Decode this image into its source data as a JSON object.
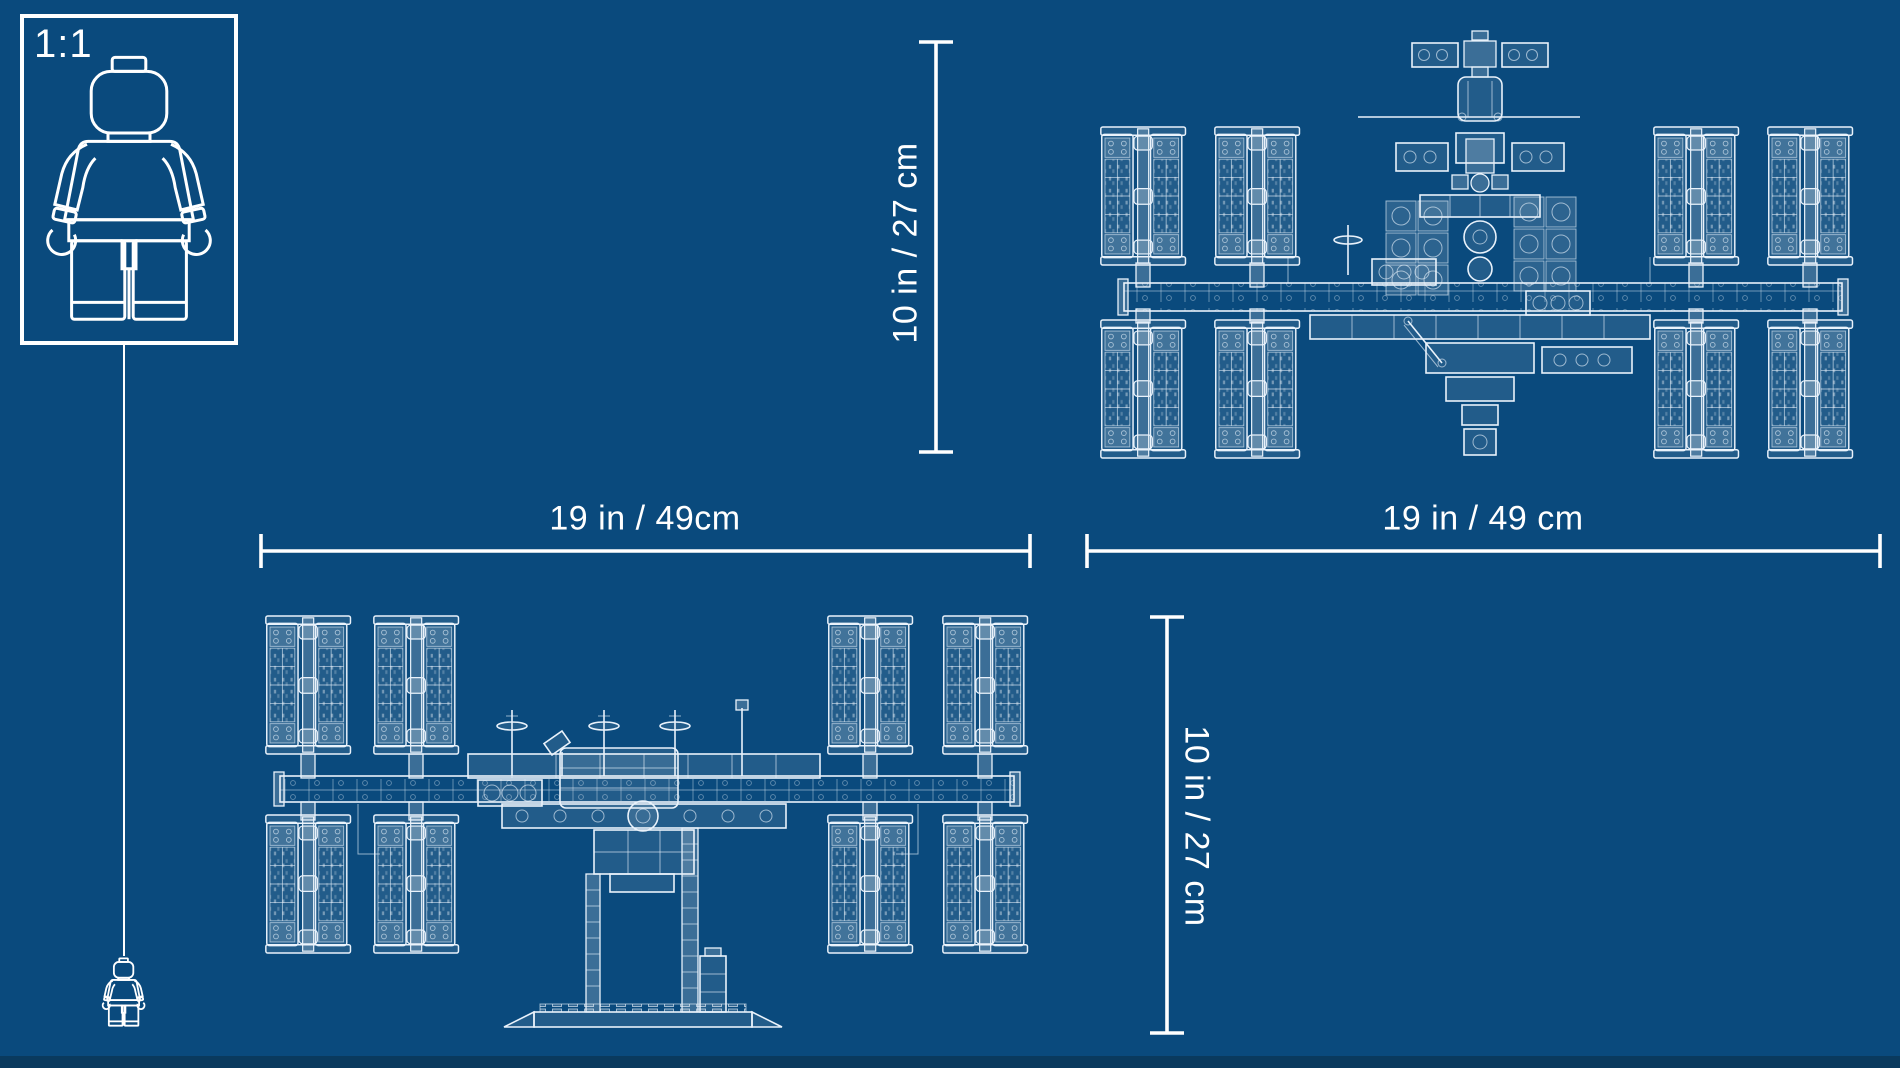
{
  "page": {
    "background_color": "#0a4a7d",
    "bottom_strip_color": "#0a3a5e",
    "line_color": "#ffffff",
    "art_line_color": "#e9f2fb"
  },
  "scale_reference": {
    "ratio_label": "1:1",
    "figure_icon": "lego-minifigure-outline",
    "small_figure_icon": "lego-minifigure-outline"
  },
  "views": {
    "top_view": {
      "name": "iss-top-view-blueprint",
      "width_label": "19 in / 49 cm",
      "height_label": "10 in / 27 cm"
    },
    "front_view": {
      "name": "iss-front-view-blueprint",
      "width_label": "19 in / 49cm",
      "height_label": "10 in / 27 cm"
    }
  }
}
